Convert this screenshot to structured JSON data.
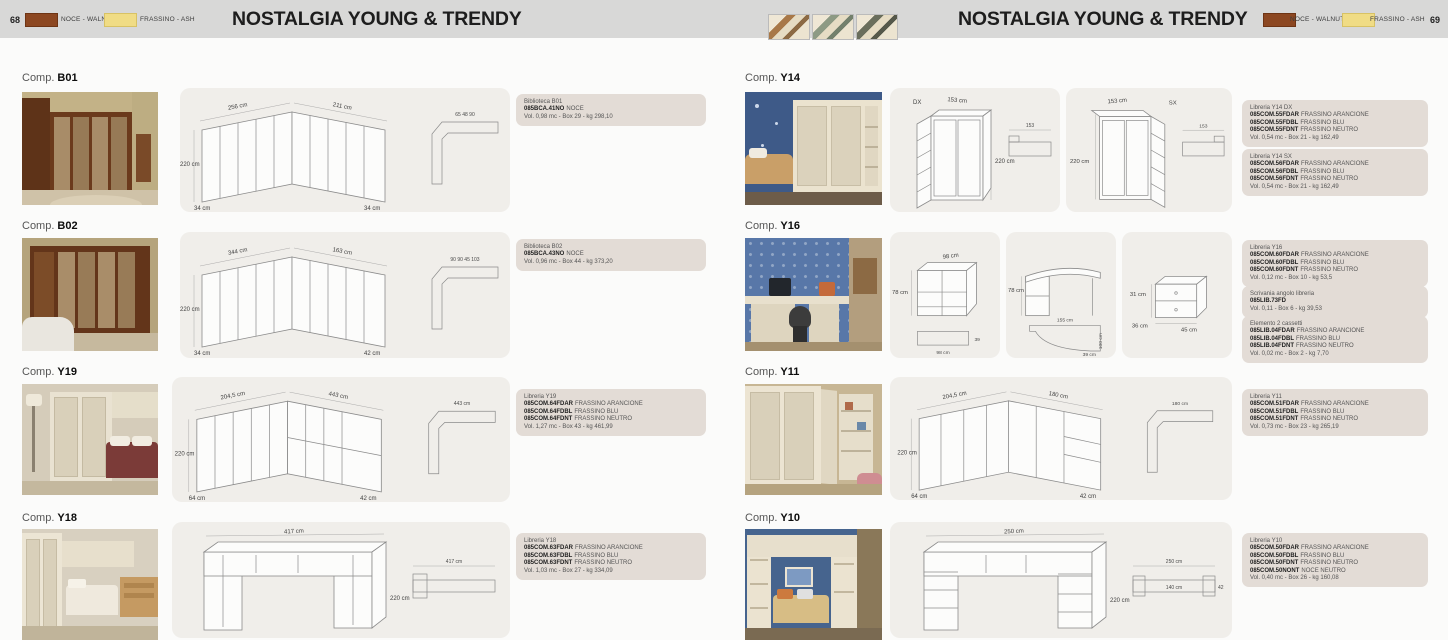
{
  "header": {
    "title": "NOSTALGIA YOUNG & TRENDY",
    "left_page_number": "68",
    "right_page_number": "69",
    "walnut_label": "NOCE - WALNUT",
    "ash_label": "FRASSINO - ASH",
    "walnut_color": "#8c4721",
    "ash_color": "#f0dc85",
    "detail_thumbnails": [
      "frame-corner-detail-1",
      "frame-corner-detail-2",
      "frame-corner-detail-3"
    ]
  },
  "comp_prefix": "Comp.",
  "compositions": {
    "b01": {
      "code": "B01",
      "dims": {
        "w1": "256 cm",
        "w2": "211 cm",
        "h": "220 cm",
        "d1": "34 cm",
        "d2": "34 cm",
        "plan": "65  48  90"
      },
      "info": {
        "name": "Biblioteca B01",
        "codes": [
          {
            "code": "085BCA.41NO",
            "finish": "NOCE"
          }
        ],
        "vol": "Vol. 0,98 mc - Box 29 -  kg 298,10"
      }
    },
    "b02": {
      "code": "B02",
      "dims": {
        "w1": "344 cm",
        "w2": "163 cm",
        "h": "220 cm",
        "d1": "34 cm",
        "d2": "42 cm",
        "plan": "90  90  45  103"
      },
      "info": {
        "name": "Biblioteca B02",
        "codes": [
          {
            "code": "085BCA.43NO",
            "finish": "NOCE"
          }
        ],
        "vol": "Vol. 0,96 mc - Box 44 -  kg 373,20"
      }
    },
    "y19": {
      "code": "Y19",
      "dims": {
        "w1": "204,5 cm",
        "w2": "443 cm",
        "h": "220 cm",
        "d1": "64 cm",
        "d2": "42 cm",
        "plan": "443 cm"
      },
      "info": {
        "name": "Libreria Y19",
        "codes": [
          {
            "code": "085COM.64FDAR",
            "finish": "FRASSINO ARANCIONE"
          },
          {
            "code": "085COM.64FDBL",
            "finish": "FRASSINO BLU"
          },
          {
            "code": "085COM.64FDNT",
            "finish": "FRASSINO NEUTRO"
          }
        ],
        "vol": "Vol. 1,27 mc - Box 43 -  kg 461,99"
      }
    },
    "y18": {
      "code": "Y18",
      "dims": {
        "w": "417 cm",
        "h": "220 cm",
        "plan": "417 cm"
      },
      "info": {
        "name": "Libreria Y18",
        "codes": [
          {
            "code": "085COM.63FDAR",
            "finish": "FRASSINO ARANCIONE"
          },
          {
            "code": "085COM.63FDBL",
            "finish": "FRASSINO BLU"
          },
          {
            "code": "085COM.63FDNT",
            "finish": "FRASSINO NEUTRO"
          }
        ],
        "vol": "Vol. 1,03 mc - Box 27 -  kg 334,09"
      }
    },
    "y14": {
      "code": "Y14"
    },
    "y14dx": {
      "side": "DX",
      "dims": {
        "w": "153 cm",
        "h": "220 cm",
        "plan": "153"
      },
      "info": {
        "name": "Libreria Y14  DX",
        "codes": [
          {
            "code": "085COM.55FDAR",
            "finish": "FRASSINO ARANCIONE"
          },
          {
            "code": "085COM.55FDBL",
            "finish": "FRASSINO BLU"
          },
          {
            "code": "085COM.55FDNT",
            "finish": "FRASSINO NEUTRO"
          }
        ],
        "vol": "Vol. 0,54 mc - Box 21 -  kg 162,49"
      }
    },
    "y14sx": {
      "side": "SX",
      "dims": {
        "w": "153 cm",
        "h": "220 cm",
        "plan": "153"
      },
      "info": {
        "name": "Libreria Y14  SX",
        "codes": [
          {
            "code": "085COM.56FDAR",
            "finish": "FRASSINO ARANCIONE"
          },
          {
            "code": "085COM.56FDBL",
            "finish": "FRASSINO BLU"
          },
          {
            "code": "085COM.56FDNT",
            "finish": "FRASSINO NEUTRO"
          }
        ],
        "vol": "Vol. 0,54 mc - Box 21 -  kg 162,49"
      }
    },
    "y16": {
      "code": "Y16",
      "unit_bookcase": {
        "dims": {
          "w": "98 cm",
          "h": "78 cm",
          "plan_w": "98 cm",
          "plan_d": "39"
        }
      },
      "unit_desk": {
        "dims": {
          "h": "78 cm",
          "plan_w": "155 cm",
          "plan_d": "100 cm",
          "plan_r": "39 cm"
        }
      },
      "unit_drawers": {
        "dims": {
          "h": "31 cm",
          "d": "36 cm",
          "w": "45 cm"
        }
      },
      "info_a": {
        "name": "Libreria Y16",
        "codes": [
          {
            "code": "085COM.60FDAR",
            "finish": "FRASSINO ARANCIONE"
          },
          {
            "code": "085COM.60FDBL",
            "finish": "FRASSINO BLU"
          },
          {
            "code": "085COM.60FDNT",
            "finish": "FRASSINO NEUTRO"
          }
        ],
        "vol": "Vol. 0,12 mc - Box 10 -  kg 53,5"
      },
      "info_b": {
        "name": "Scrivania angolo libreria",
        "codes": [
          {
            "code": "085LIB.73FD",
            "finish": ""
          }
        ],
        "vol": "Vol. 0,11 - Box 6 -  kg 39,53"
      },
      "info_c": {
        "name": "Elemento 2 cassetti",
        "codes": [
          {
            "code": "085LIB.04FDAR",
            "finish": "FRASSINO ARANCIONE"
          },
          {
            "code": "085LIB.04FDBL",
            "finish": "FRASSINO BLU"
          },
          {
            "code": "085LIB.04FDNT",
            "finish": "FRASSINO NEUTRO"
          }
        ],
        "vol": "Vol. 0,02 mc - Box 2 -  kg 7,70"
      }
    },
    "y11": {
      "code": "Y11",
      "dims": {
        "w1": "204,5 cm",
        "w2": "180 cm",
        "h": "220 cm",
        "d1": "64 cm",
        "d2": "42 cm",
        "plan": "180 cm"
      },
      "info": {
        "name": "Libreria Y11",
        "codes": [
          {
            "code": "085COM.51FDAR",
            "finish": "FRASSINO ARANCIONE"
          },
          {
            "code": "085COM.51FDBL",
            "finish": "FRASSINO BLU"
          },
          {
            "code": "085COM.51FDNT",
            "finish": "FRASSINO NEUTRO"
          }
        ],
        "vol": "Vol. 0,73 mc - Box 23 -  kg 265,19"
      }
    },
    "y10": {
      "code": "Y10",
      "dims": {
        "w": "250 cm",
        "h": "220 cm",
        "plan": "250 cm",
        "plan_mid": "140 cm",
        "plan_d": "42"
      },
      "info": {
        "name": "Libreria Y10",
        "codes": [
          {
            "code": "085COM.50FDAR",
            "finish": "FRASSINO ARANCIONE"
          },
          {
            "code": "085COM.50FDBL",
            "finish": "FRASSINO BLU"
          },
          {
            "code": "085COM.50FDNT",
            "finish": "FRASSINO NEUTRO"
          },
          {
            "code": "085COM.50NONT",
            "finish": "NOCE NEUTRO"
          }
        ],
        "vol": "Vol. 0,40 mc - Box 26 -  kg 160,08"
      }
    }
  }
}
